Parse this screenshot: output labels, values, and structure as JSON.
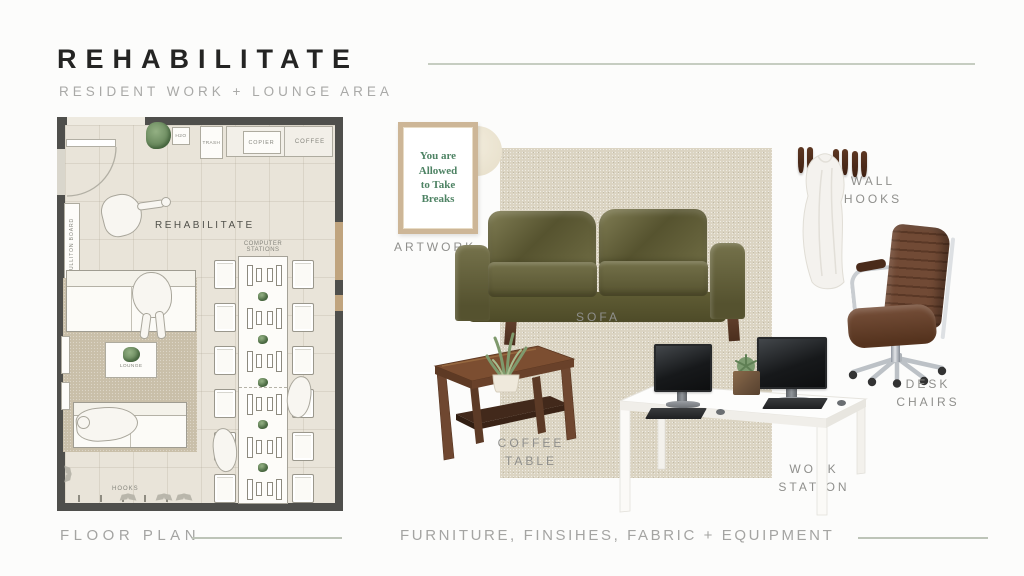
{
  "header": {
    "title": "REHABILITATE",
    "subtitle": "RESIDENT WORK + LOUNGE AREA"
  },
  "sections": {
    "floor_plan_label": "FLOOR PLAN",
    "board_label": "FURNITURE, FINSIHES, FABRIC + EQUIPMENT"
  },
  "floor_plan": {
    "room_label": "REHABILITATE",
    "h2o_label": "H2O",
    "trash_label": "TRASH",
    "copier_label": "COPIER",
    "coffee_label": "COFFEE",
    "bulletin_label": "BULLITON BOARD",
    "computer_label_line1": "COMPUTER",
    "computer_label_line2": "STATIONS",
    "lounge_label": "LOUNGE",
    "hooks_label": "HOOKS"
  },
  "board": {
    "artwork": {
      "label": "ARTWORK",
      "poster_line1": "You are",
      "poster_line2": "Allowed",
      "poster_line3": "to Take",
      "poster_line4": "Breaks"
    },
    "sofa": {
      "label": "SOFA"
    },
    "wall_hooks": {
      "label_line1": "WALL",
      "label_line2": "HOOKS"
    },
    "desk_chairs": {
      "label_line1": "DESK",
      "label_line2": "CHAIRS"
    },
    "coffee_table": {
      "label_line1": "COFFEE",
      "label_line2": "TABLE"
    },
    "work_station": {
      "label_line1": "WORK",
      "label_line2": "STATION"
    }
  },
  "colors": {
    "accent_line": "#c6cdc1",
    "sofa_green": "#6c6a42",
    "wood_brown": "#6f452e",
    "hook_brown": "#4c2a1a",
    "plant_green": "#7d9b70",
    "rug_beige": "#dbd4c2",
    "wall_gray": "#4f4f4c",
    "poster_green": "#4e8364"
  }
}
